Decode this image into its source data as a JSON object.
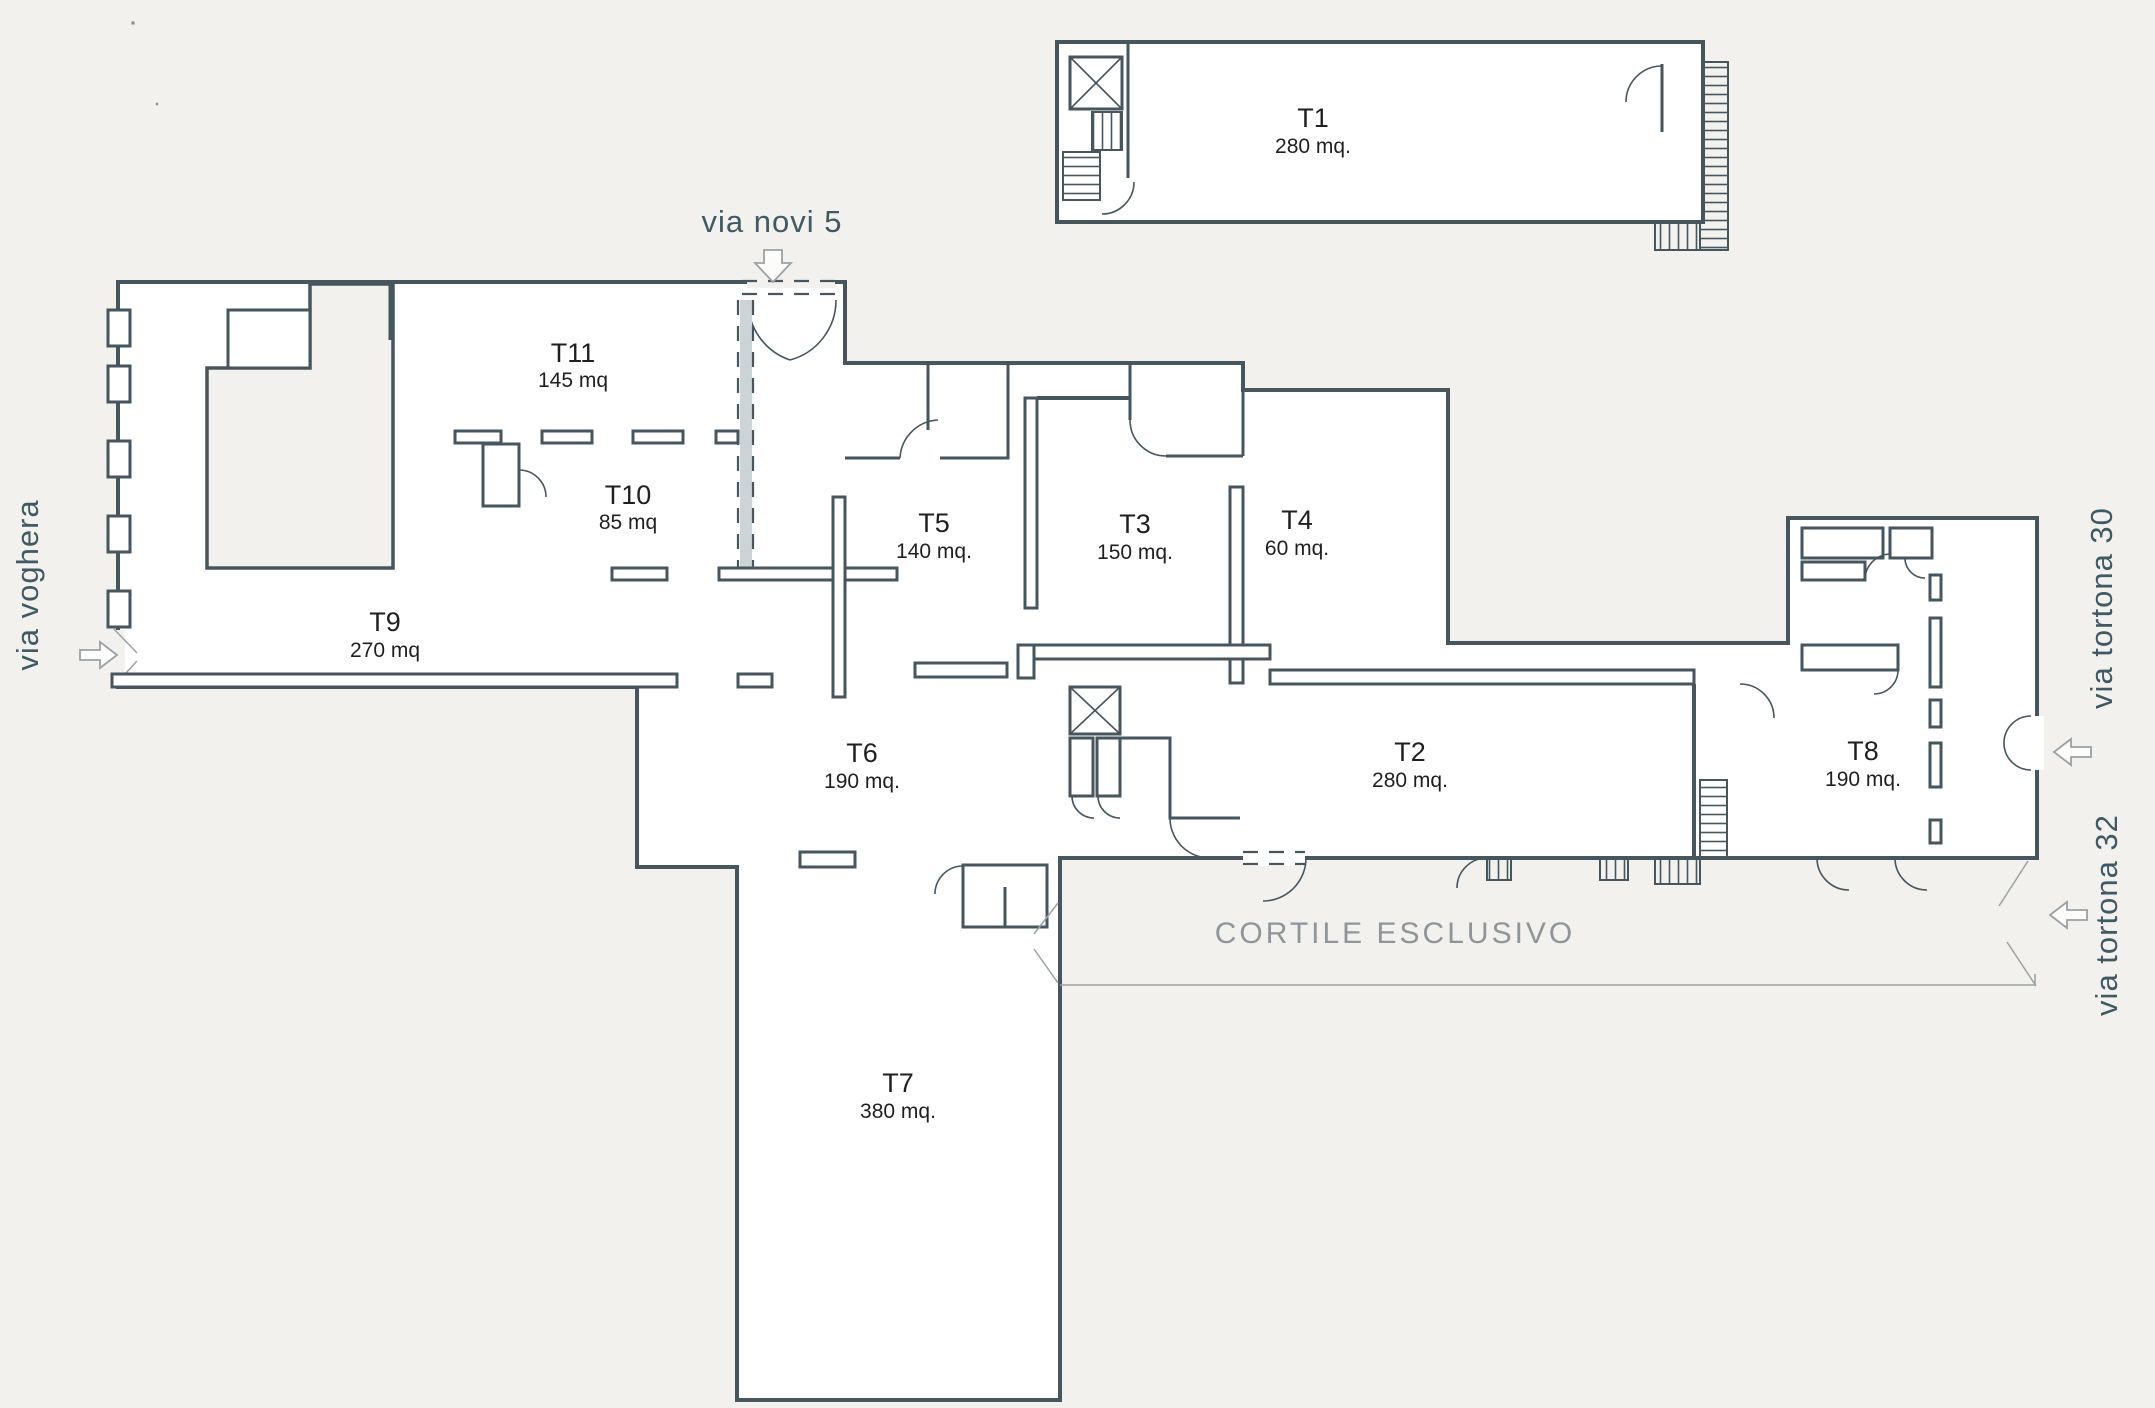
{
  "plan": {
    "units": [
      {
        "id": "T1",
        "area": "280 mq."
      },
      {
        "id": "T2",
        "area": "280 mq."
      },
      {
        "id": "T3",
        "area": "150 mq."
      },
      {
        "id": "T4",
        "area": "60 mq."
      },
      {
        "id": "T5",
        "area": "140 mq."
      },
      {
        "id": "T6",
        "area": "190 mq."
      },
      {
        "id": "T7",
        "area": "380 mq."
      },
      {
        "id": "T8",
        "area": "190 mq."
      },
      {
        "id": "T9",
        "area": "270 mq"
      },
      {
        "id": "T10",
        "area": "85 mq"
      },
      {
        "id": "T11",
        "area": "145 mq"
      }
    ],
    "streets": {
      "north": "via novi 5",
      "west": "via voghera",
      "east_upper": "via tortona 30",
      "east_lower": "via tortona 32"
    },
    "courtyard_label": "CORTILE ESCLUSIVO",
    "colors": {
      "background": "#f2f1ee",
      "wall": "#45565f",
      "street_text": "#3e5a64",
      "unit_text": "#1f1f1f",
      "courtyard_text": "#8f959a"
    }
  }
}
